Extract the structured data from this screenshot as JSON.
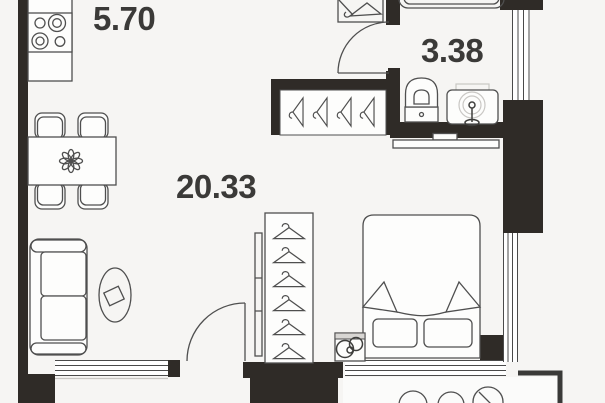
{
  "floorplan": {
    "type": "apartment-floor-plan",
    "rooms": [
      {
        "name": "kitchen-zone",
        "area_label": "5.70"
      },
      {
        "name": "bathroom",
        "area_label": "3.38"
      },
      {
        "name": "living-zone",
        "area_label": "20.33"
      }
    ],
    "colors": {
      "wall": "#2f2b27",
      "furniture_line": "#4f4f4f",
      "light_line": "#c9c7c4",
      "background": "#f6f5f3",
      "label_text": "#3b3a38"
    },
    "icons": [
      "stove-icon",
      "dining-table-icon",
      "chair-icon",
      "flower-icon",
      "sofa-icon",
      "rug-icon",
      "hanger-icon",
      "bed-icon",
      "pillow-icon",
      "washing-machine-icon",
      "toilet-icon",
      "sink-icon",
      "bathtub-icon",
      "window-icon",
      "door-swing-icon",
      "balcony-furniture-icon"
    ]
  }
}
